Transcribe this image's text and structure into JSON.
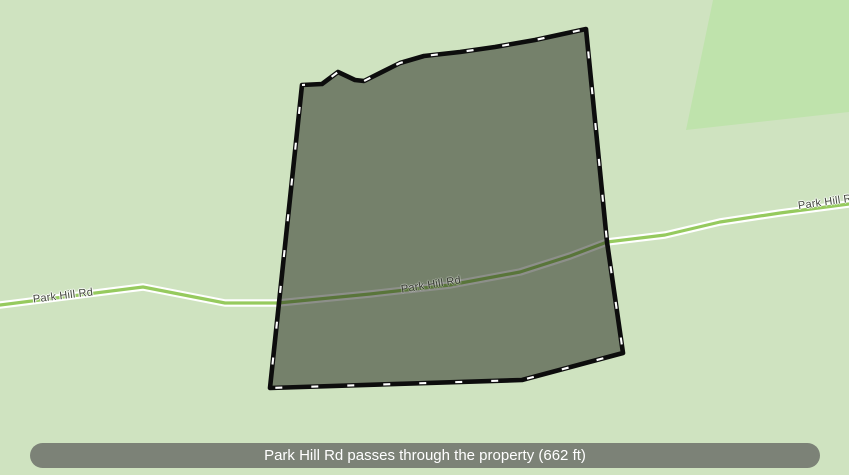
{
  "colors": {
    "background": "#cfe3c0",
    "forest_patch": "#bfe3ac",
    "parcel_fill": "rgba(27,31,22,0.5)",
    "parcel_border": "#0d0d0d",
    "parcel_dash": "#ffffff",
    "road": "#96ca5e",
    "road_casing": "#ffffff",
    "road_label": "#44483e",
    "road_label_dark": "#383c33",
    "road_label_halo": "rgba(255,255,255,0.85)",
    "status_bar_bg": "#7c8277",
    "status_bar_text": "#ffffff"
  },
  "road": {
    "name": "Park Hill Rd"
  },
  "labels": {
    "road_left": "Park Hill Rd",
    "road_center": "Park Hill Rd",
    "road_right": "Park Hill Rd"
  },
  "status_bar": {
    "text": "Park Hill Rd passes through the property (662 ft)",
    "road_length_ft": 662
  }
}
